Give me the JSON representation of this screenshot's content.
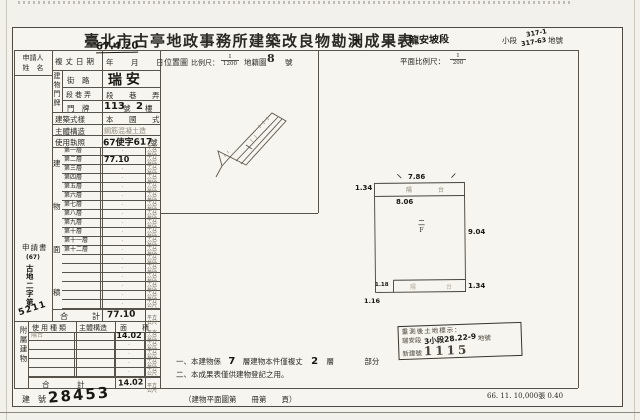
{
  "title": {
    "main": "臺北市古亭地政事務所建築改良物勘測成果表",
    "hand_big": "大",
    "site_label": "坐落",
    "district_label": "區",
    "section_hand": "龍安坡段",
    "subsection_label": "小段",
    "subsection_hand_1": "317-1",
    "subsection_hand_2": "317-63",
    "land_no_label": "地號"
  },
  "scales": {
    "location_map": "位置圖",
    "scale_label": "比例尺：",
    "loc_num": "1",
    "loc_den": "1200",
    "cadastral_map": "地籍圖",
    "cadastral_no": "8",
    "no_unit": "號",
    "plan_scale_label": "平面比例尺：",
    "plan_num": "1",
    "plan_den": "200"
  },
  "applicant": {
    "line1": "申請人",
    "line2": "姓　名"
  },
  "left_table": {
    "survey_date_label": "複丈日期",
    "survey_date_value": "年　月　日",
    "survey_date_hand": "67.4.20",
    "address_group": "建物門牌",
    "street_label": "街　路",
    "street_hand": "瑞安",
    "lane_label": "段巷弄",
    "lane_value": "段　巷　弄",
    "door_label": "門　牌",
    "door_hand_no": "113",
    "door_no_unit": "號",
    "door_hand_floor": "2",
    "door_floor_unit": "樓",
    "style_label": "建築式樣",
    "style_value": "本　國　式",
    "structure_label": "主體構造",
    "structure_stamp": "鋼筋混凝土造",
    "license_label": "使用執照",
    "license_hand": "67使字617",
    "license_unit": "號",
    "area_group": "建物面積",
    "unit_line1": "平方",
    "unit_line2": "公尺",
    "floors": [
      {
        "label": "第一層",
        "dot": "·",
        "hand": ""
      },
      {
        "label": "第二層",
        "dot": "·",
        "hand": "77.10"
      },
      {
        "label": "第三層",
        "dot": "·",
        "hand": ""
      },
      {
        "label": "第四層",
        "dot": "·",
        "hand": ""
      },
      {
        "label": "第五層",
        "dot": "·",
        "hand": ""
      },
      {
        "label": "第六層",
        "dot": "·",
        "hand": ""
      },
      {
        "label": "第七層",
        "dot": "·",
        "hand": ""
      },
      {
        "label": "第八層",
        "dot": "·",
        "hand": ""
      },
      {
        "label": "第九層",
        "dot": "·",
        "hand": ""
      },
      {
        "label": "第十層",
        "dot": "·",
        "hand": ""
      },
      {
        "label": "第十一層",
        "dot": "·",
        "hand": ""
      },
      {
        "label": "第十二層",
        "dot": "·",
        "hand": ""
      },
      {
        "label": "",
        "dot": "·",
        "hand": ""
      },
      {
        "label": "",
        "dot": "·",
        "hand": ""
      },
      {
        "label": "",
        "dot": "·",
        "hand": ""
      },
      {
        "label": "",
        "dot": "·",
        "hand": ""
      },
      {
        "label": "",
        "dot": "·",
        "hand": ""
      },
      {
        "label": "",
        "dot": "·",
        "hand": ""
      }
    ],
    "total_label": "合　計",
    "total_hand": "77.10",
    "attachment_group": "附屬建物",
    "att_headers": [
      "使用種類",
      "主體構造",
      "面　積"
    ],
    "att_rows": [
      {
        "use": "陽台",
        "dot": "",
        "area_hand": "14.02"
      },
      {
        "use": "",
        "dot": "·",
        "area_hand": ""
      },
      {
        "use": "",
        "dot": "·",
        "area_hand": ""
      },
      {
        "use": "",
        "dot": "·",
        "area_hand": ""
      },
      {
        "use": "",
        "dot": "·",
        "area_hand": ""
      }
    ],
    "att_total_label": "合　計",
    "att_total_hand": "14.02",
    "application_label": "申請書",
    "application_hand": [
      "(67)",
      "古",
      "地",
      "二",
      "字",
      "第"
    ],
    "application_no": "5211"
  },
  "plan": {
    "floor_mark_1": "二",
    "floor_mark_2": "F",
    "balcony_top": "陽　台",
    "balcony_bottom": "陽　台",
    "dims": {
      "top": "7.86",
      "left_top": "1.34",
      "inner_top": "8.06",
      "right": "9.04",
      "notch": "1.18",
      "below_notch": "1.16",
      "bottom_right": "1.34"
    }
  },
  "stamp": {
    "line1": "重測後土地標示：",
    "sec": "瑞安段",
    "hand": "3小段28.22-9",
    "land": "地號",
    "new_label": "新建號",
    "new_no": "1115"
  },
  "notes": {
    "n1_pre": "一、本建物係",
    "n1_hand1": "7",
    "n1_mid": "層建物本件僅複丈",
    "n1_hand2": "2",
    "n1_post": "層",
    "n1_end": "部分",
    "n2": "二、本成果表僅供建物登記之用。"
  },
  "footer": {
    "bno_label1": "建",
    "bno_label2": "號",
    "bno_hand": "28453",
    "plan_page": "（建物平面圖第　　冊第　　頁）",
    "print_info": "66. 11. 10,000張 0.40"
  }
}
